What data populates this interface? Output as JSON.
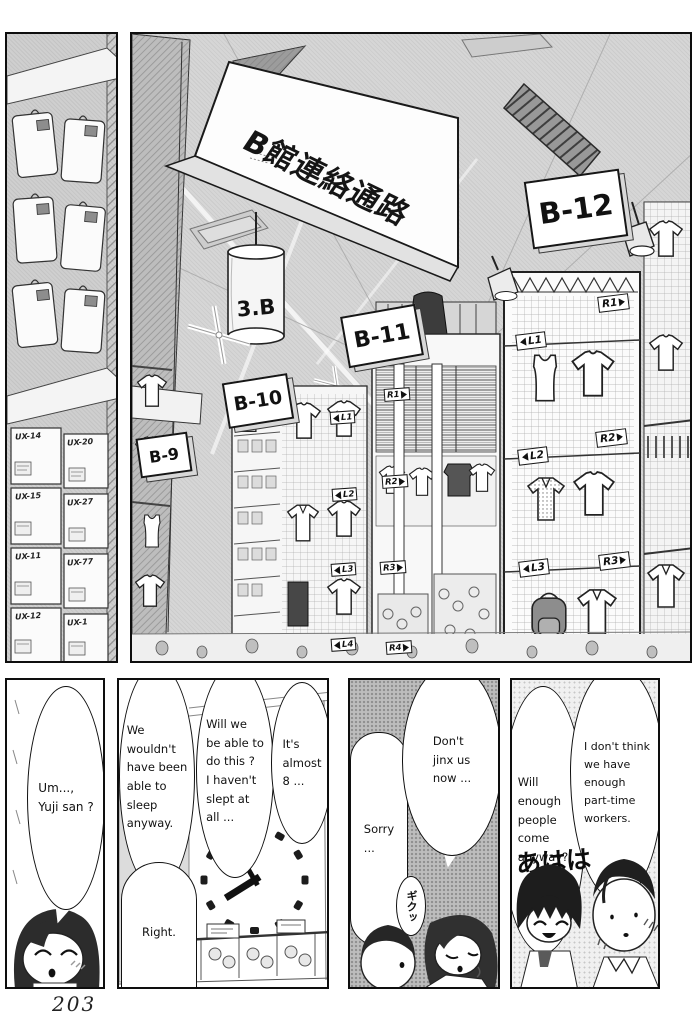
{
  "page": {
    "number": "203"
  },
  "store": {
    "overhead_sign": "B館連絡通路",
    "cylinder_sign": "3.B",
    "section_signs": [
      "B-9",
      "B-10",
      "B-11",
      "B-12"
    ],
    "aisle_markers": {
      "tower_left": [
        "L1",
        "L2",
        "L3"
      ],
      "tower_right": [
        "R1",
        "R2",
        "R3"
      ],
      "mid_rack": [
        "R1",
        "R2",
        "R3",
        "R4"
      ],
      "left_wall": [
        "L1",
        "L2",
        "L3",
        "L4"
      ]
    },
    "box_labels": [
      "UX-14",
      "UX-20",
      "UX-15",
      "UX-27",
      "UX-11",
      "UX-77",
      "UX-12",
      "UX-1"
    ]
  },
  "dialogue": {
    "p1_um": "Um...,\nYuji san ?",
    "p2_wouldnt": "We\nwouldn't\nhave been\nable to\nsleep\nanyway.",
    "p2_willwe": "Will we\nbe able to\ndo this ?\nI haven't\nslept at\nall ...",
    "p2_almost8": "It's\nalmost\n8 ...",
    "p2_right": "Right.",
    "p3_sorry": "Sorry\n...",
    "p3_jinx": "Don't\njinx us\nnow ...",
    "p3_sfx": "ギクッ",
    "p4_willenough": "Will\nenough\npeople\ncome\nanyway?",
    "p4_dontthink": "I don't think\nwe have\nenough\npart-time\nworkers.",
    "p4_laugh": "あはは"
  }
}
